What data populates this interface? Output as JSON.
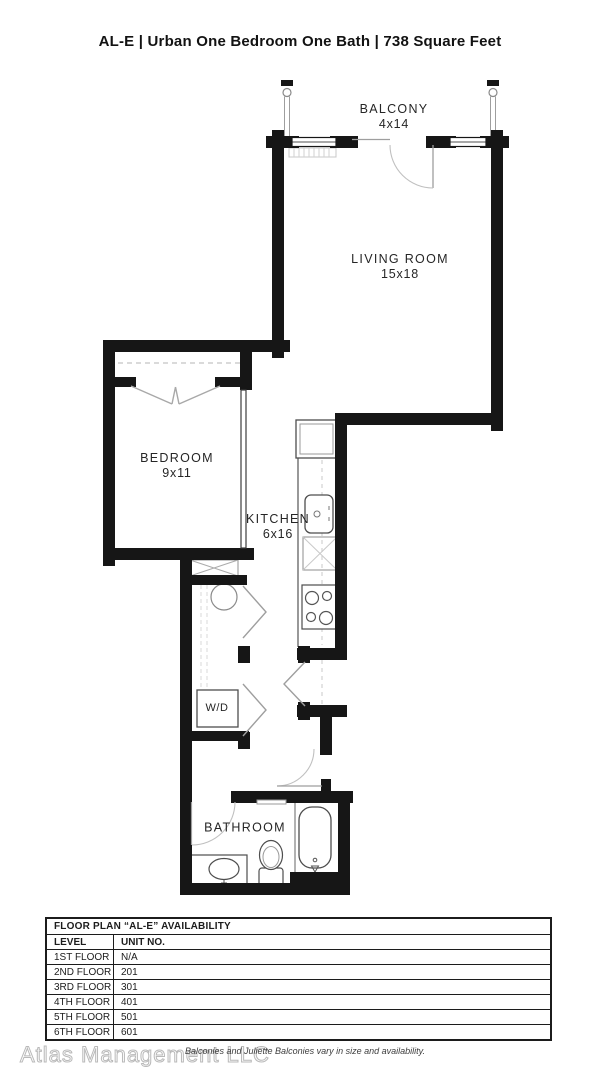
{
  "header": {
    "title": "AL-E | Urban One Bedroom One Bath | 738 Square Feet"
  },
  "floor_plan": {
    "rooms": {
      "balcony": {
        "name": "BALCONY",
        "dims": "4x14"
      },
      "living_room": {
        "name": "LIVING ROOM",
        "dims": "15x18"
      },
      "bedroom": {
        "name": "BEDROOM",
        "dims": "9x11"
      },
      "kitchen": {
        "name": "KITCHEN",
        "dims": "6x16"
      },
      "bathroom": {
        "name": "BATHROOM"
      },
      "laundry": {
        "label": "W/D"
      }
    },
    "fixtures": [
      "balcony-railing",
      "refrigerator",
      "kitchen-sink",
      "dishwasher",
      "stove",
      "water-heater",
      "washer-dryer",
      "bathtub",
      "toilet",
      "vanity-sink"
    ],
    "colors": {
      "wall": "#161616",
      "fixture_line": "#555555",
      "light_line": "#bbbbbb"
    }
  },
  "availability_table": {
    "title": "FLOOR PLAN “AL-E” AVAILABILITY",
    "columns": [
      "LEVEL",
      "UNIT NO."
    ],
    "rows": [
      {
        "level": "1ST FLOOR",
        "unit": "N/A"
      },
      {
        "level": "2ND FLOOR",
        "unit": "201"
      },
      {
        "level": "3RD FLOOR",
        "unit": "301"
      },
      {
        "level": "4TH FLOOR",
        "unit": "401"
      },
      {
        "level": "5TH FLOOR",
        "unit": "501"
      },
      {
        "level": "6TH FLOOR",
        "unit": "601"
      }
    ]
  },
  "footer": {
    "watermark": "Atlas Management LLC",
    "disclaimer": "Balconies and Juliette Balconies vary in size and availability."
  }
}
